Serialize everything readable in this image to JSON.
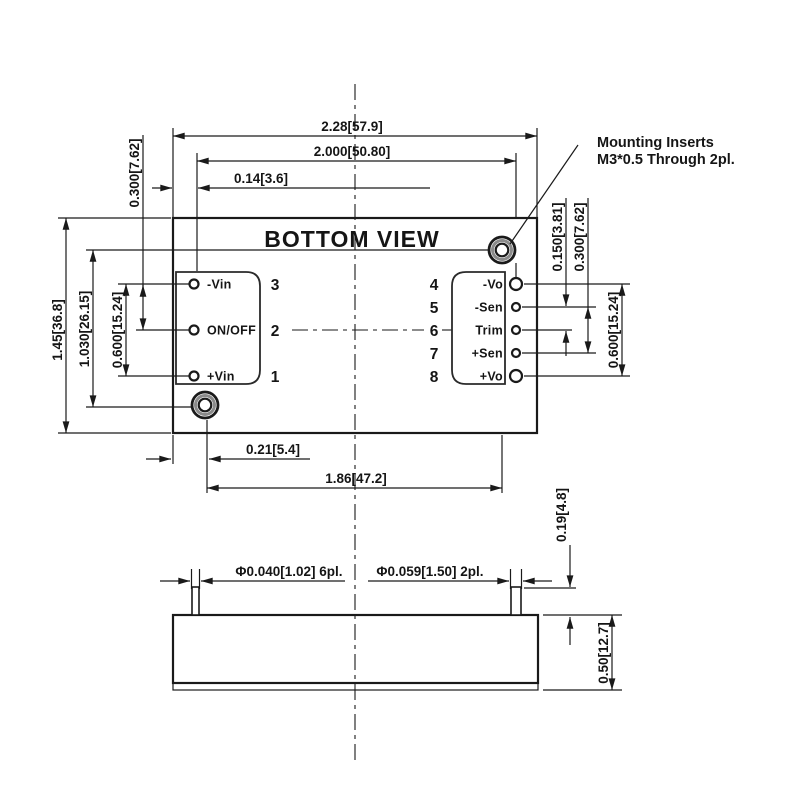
{
  "title": "BOTTOM VIEW",
  "note": {
    "line1": "Mounting Inserts",
    "line2": "M3*0.5 Through 2pl."
  },
  "dims": {
    "overall_width": "2.28[57.9]",
    "pin_span_h": "2.000[50.80]",
    "pin_edge_offset": "0.14[3.6]",
    "left_pin_pitch": "0.300[7.62]",
    "overall_height": "1.45[36.8]",
    "insert_spacing_v": "1.030[26.15]",
    "left_pin_span": "0.600[15.24]",
    "right_pin_pitch": "0.150[3.81]",
    "right_sen_span": "0.300[7.62]",
    "right_pin_span": "0.600[15.24]",
    "insert_offset_x": "0.21[5.4]",
    "insert_span_h": "1.86[47.2]",
    "pin_length": "0.19[4.8]",
    "case_height": "0.50[12.7]",
    "pin_dia_small": "Φ0.040[1.02] 6pl.",
    "pin_dia_large": "Φ0.059[1.50] 2pl."
  },
  "left_pins": [
    {
      "num": "3",
      "label": "-Vin"
    },
    {
      "num": "2",
      "label": "ON/OFF"
    },
    {
      "num": "1",
      "label": "+Vin"
    }
  ],
  "right_pins": [
    {
      "num": "4",
      "label": "-Vo"
    },
    {
      "num": "5",
      "label": "-Sen"
    },
    {
      "num": "6",
      "label": "Trim"
    },
    {
      "num": "7",
      "label": "+Sen"
    },
    {
      "num": "8",
      "label": "+Vo"
    }
  ],
  "colors": {
    "line": "#1a1a1a",
    "background": "#ffffff"
  }
}
